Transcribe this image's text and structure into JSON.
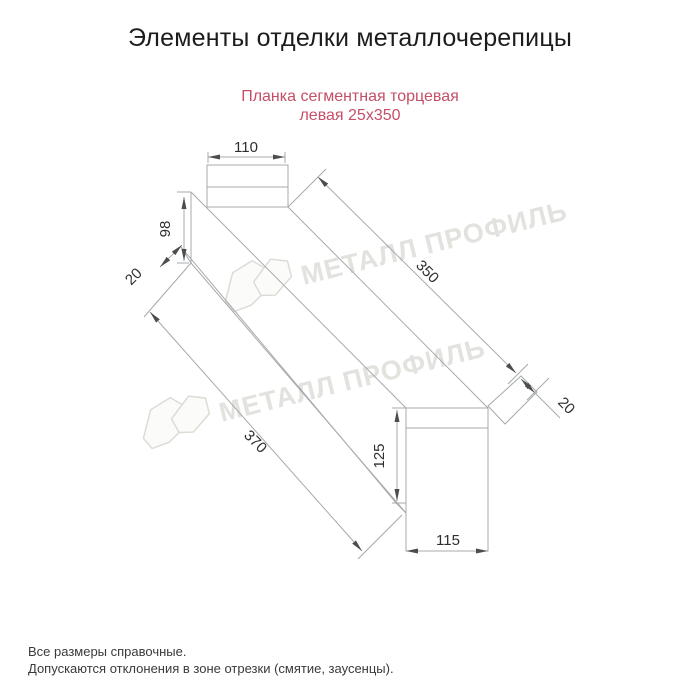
{
  "page": {
    "title": "Элементы отделки металлочерепицы",
    "subtitle_line1": "Планка сегментная торцевая",
    "subtitle_line2": "левая 25х350",
    "footnote1": "Все размеры справочные.",
    "footnote2": "Допускаются отклонения в зоне отрезки (смятие, заусенцы)."
  },
  "watermark": {
    "text1": "МЕТАЛЛ ПРОФИЛЬ",
    "text2": "МЕТАЛЛ ПРОФИЛЬ"
  },
  "drawing": {
    "dim_top_width": "110",
    "dim_left_height": "98",
    "dim_left_fold": "20",
    "dim_length_top": "350",
    "dim_right_fold": "20",
    "dim_length_bottom": "370",
    "dim_end_height": "125",
    "dim_end_width": "115"
  },
  "colors": {
    "subtitle_text": "#c44f66",
    "drawing_line": "#a6aaad",
    "arrow": "#4d4d4d",
    "dim_text": "#2e2e2e",
    "watermark": "#e2e2de"
  }
}
